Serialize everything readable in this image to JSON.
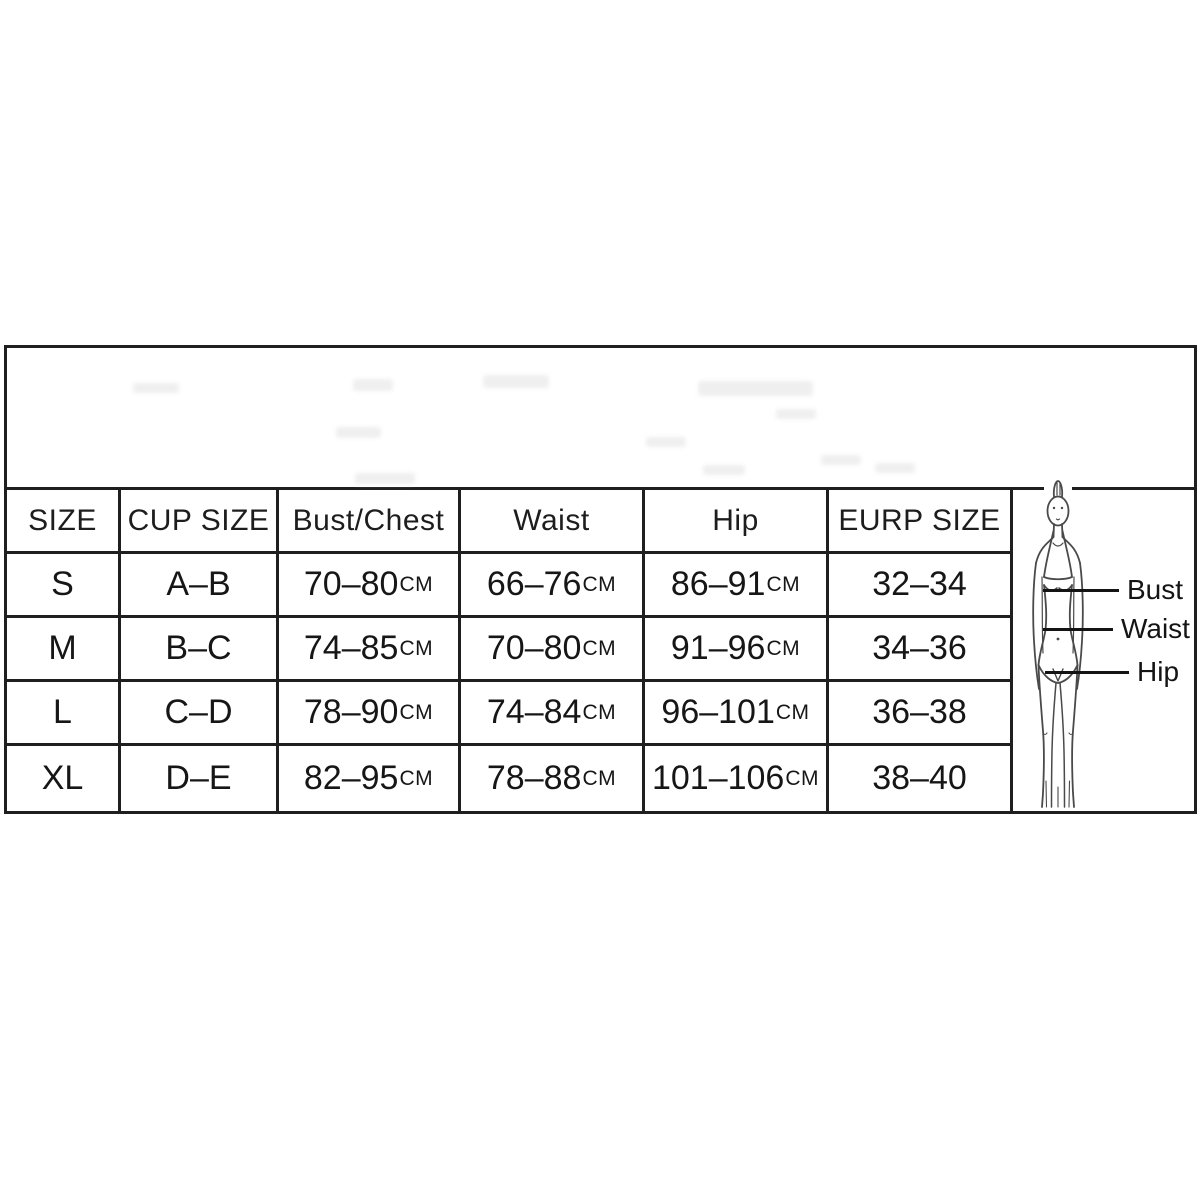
{
  "table": {
    "unit": "CM",
    "headers": [
      "SIZE",
      "CUP SIZE",
      "Bust/Chest",
      "Waist",
      "Hip",
      "EURP SIZE"
    ],
    "rows": [
      {
        "size": "S",
        "cup": "A–B",
        "bust": "70–80",
        "waist": "66–76",
        "hip": "86–91",
        "eu": "32–34"
      },
      {
        "size": "M",
        "cup": "B–C",
        "bust": "74–85",
        "waist": "70–80",
        "hip": "91–96",
        "eu": "34–36"
      },
      {
        "size": "L",
        "cup": "C–D",
        "bust": "78–90",
        "waist": "74–84",
        "hip": "96–101",
        "eu": "36–38"
      },
      {
        "size": "XL",
        "cup": "D–E",
        "bust": "82–95",
        "waist": "78–88",
        "hip": "101–106",
        "eu": "38–40"
      }
    ],
    "figure_labels": {
      "bust": "Bust",
      "waist": "Waist",
      "hip": "Hip"
    },
    "colors": {
      "border": "#1f1f1f",
      "text": "#1b1b1b",
      "sketch": "#4a4a4a"
    }
  },
  "chart_data": {
    "type": "table",
    "title": "Garment size chart with body measurement diagram",
    "columns": [
      "SIZE",
      "CUP SIZE",
      "Bust/Chest",
      "Waist",
      "Hip",
      "EURP SIZE"
    ],
    "rows": [
      [
        "S",
        "A–B",
        "70–80CM",
        "66–76CM",
        "86–91CM",
        "32–34"
      ],
      [
        "M",
        "B–C",
        "74–85CM",
        "70–80CM",
        "91–96CM",
        "34–36"
      ],
      [
        "L",
        "C–D",
        "78–90CM",
        "74–84CM",
        "96–101CM",
        "36–38"
      ],
      [
        "XL",
        "D–E",
        "82–95CM",
        "78–88CM",
        "101–106CM",
        "38–40"
      ]
    ],
    "annotations": [
      "Bust",
      "Waist",
      "Hip"
    ],
    "legend_position": "none",
    "grid": true
  }
}
